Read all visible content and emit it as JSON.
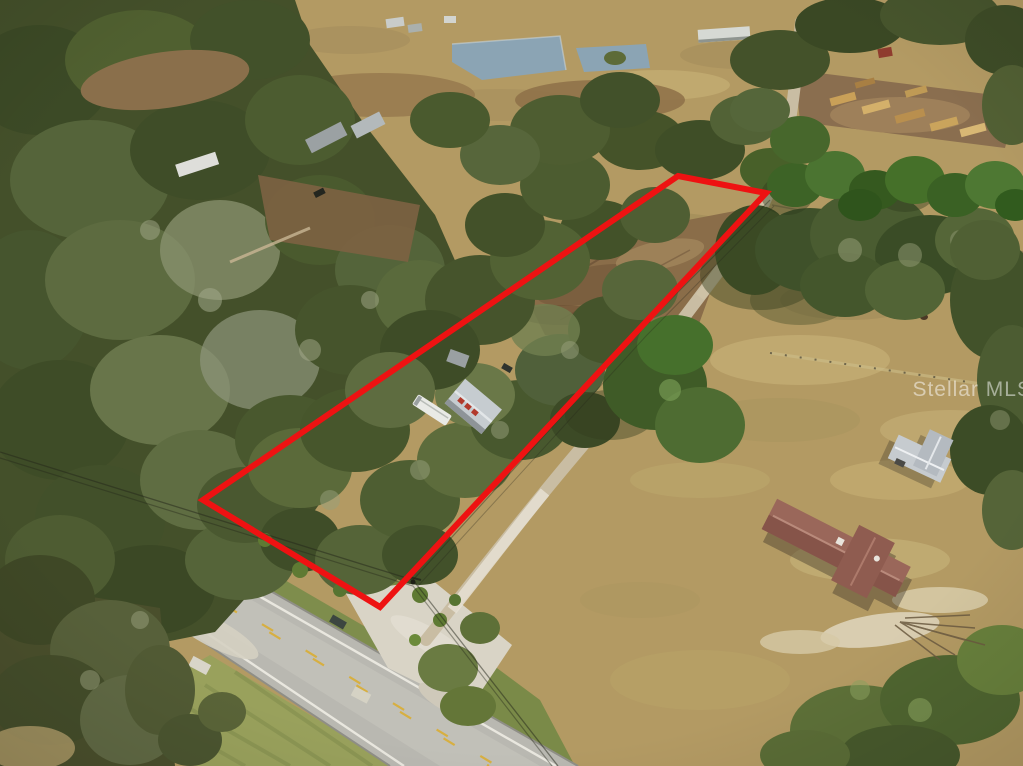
{
  "photo": {
    "watermark": "Stellar MLS",
    "boundary": {
      "points": "678,176 766,193 380,607 203,500",
      "stroke_width": 6
    },
    "colors": {
      "boundary_red": "#ee1212",
      "pasture_tan": "#b39a63",
      "forest_green": "#44502a",
      "road_asphalt": "#b9b8b1",
      "dirt_clearing": "#8a6d49",
      "gravel": "#d9d4c6",
      "driveway_track": "#c9bda3",
      "pond_water": "#8ba4b4",
      "house_roof": "#9a675a",
      "barn_roof": "#c6cbcf",
      "grass_verge": "#7e8d4c",
      "lane_yellow": "#d7af41",
      "lane_white": "#efede4",
      "watermark_white": "#ffffff"
    }
  }
}
